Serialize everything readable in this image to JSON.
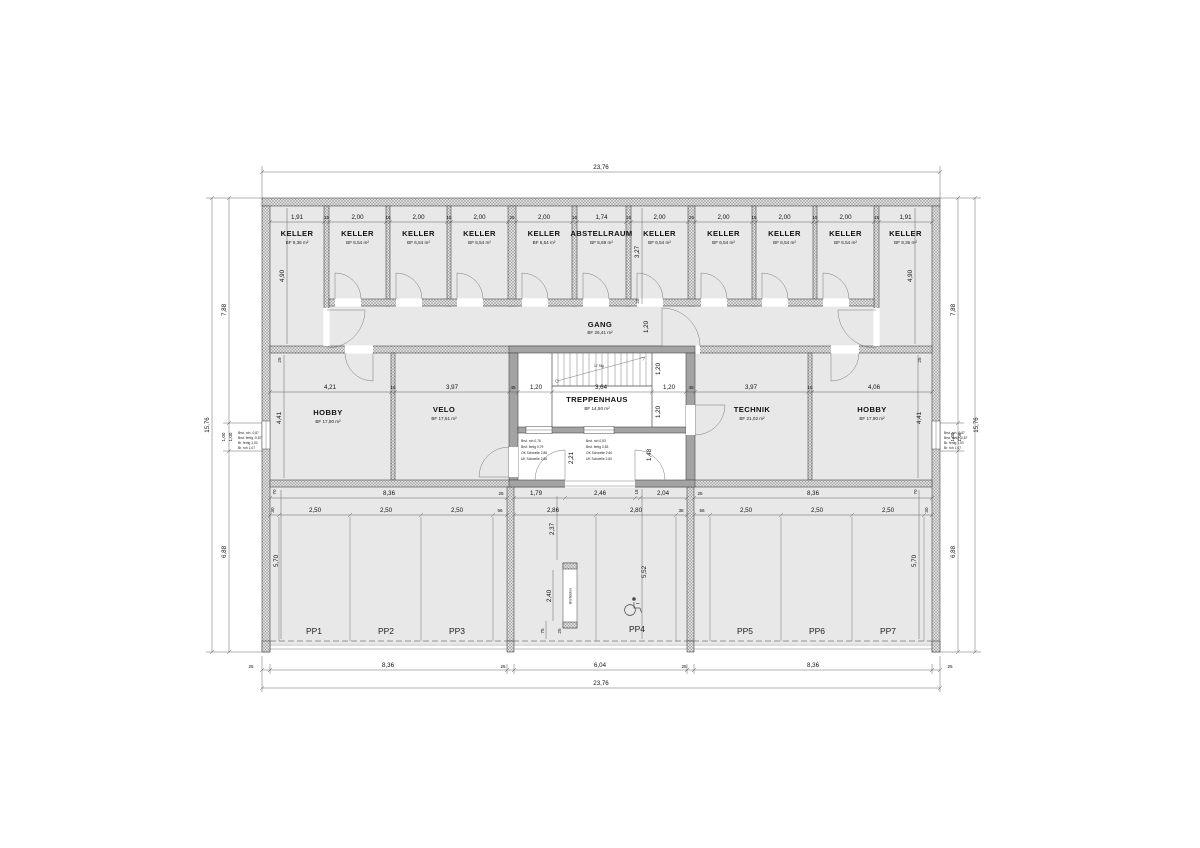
{
  "plan": {
    "top_rooms": [
      {
        "name": "KELLER",
        "area": "BF 9,36 m²"
      },
      {
        "name": "KELLER",
        "area": "BF 6,54 m²"
      },
      {
        "name": "KELLER",
        "area": "BF 6,54 m²"
      },
      {
        "name": "KELLER",
        "area": "BF 6,54 m²"
      },
      {
        "name": "KELLER",
        "area": "BF 6,54 m²"
      },
      {
        "name": "ABSTELLRAUM",
        "area": "BF 5,69 m²"
      },
      {
        "name": "KELLER",
        "area": "BF 6,54 m²"
      },
      {
        "name": "KELLER",
        "area": "BF 6,54 m²"
      },
      {
        "name": "KELLER",
        "area": "BF 6,54 m²"
      },
      {
        "name": "KELLER",
        "area": "BF 6,54 m²"
      },
      {
        "name": "KELLER",
        "area": "BF 9,36 m²"
      }
    ],
    "gang": {
      "name": "GANG",
      "area": "BF 26,41 m²"
    },
    "treppenhaus": {
      "name": "TREPPENHAUS",
      "area": "BF 14,50 m²"
    },
    "stair_note": "17 Stg.",
    "middle_rooms": [
      {
        "name": "HOBBY",
        "area": "BF 17,90 m²"
      },
      {
        "name": "VELO",
        "area": "BF 17,51 m²"
      },
      {
        "name": "TECHNIK",
        "area": "BF 21,02 m²"
      },
      {
        "name": "HOBBY",
        "area": "BF 17,90 m²"
      }
    ],
    "parking": [
      "PP1",
      "PP2",
      "PP3",
      "PP4",
      "PP5",
      "PP6",
      "PP7"
    ],
    "mailbox_label": "Briefkästen",
    "dims": {
      "top_total": "23,76",
      "bottom_total": "23,76",
      "side_total_left": "15,76",
      "side_total_right": "15,76",
      "top_chain": [
        "1,91",
        "15",
        "2,00",
        "15",
        "2,00",
        "15",
        "2,00",
        "25",
        "2,00",
        "15",
        "1,74",
        "15",
        "2,00",
        "25",
        "2,00",
        "15",
        "2,00",
        "15",
        "2,00",
        "15",
        "1,91"
      ],
      "mid_chain": [
        "4,21",
        "15",
        "3,97",
        "45",
        "1,20",
        "3,64",
        "1,20",
        "45",
        "3,97",
        "15",
        "4,06"
      ],
      "left_chain": [
        "7,88",
        "1,00",
        "1,00",
        "6,88"
      ],
      "right_chain": [
        "7,88",
        "1,00",
        "1,00",
        "6,88"
      ],
      "bottom_chain": [
        "25",
        "8,36",
        "25",
        "6,04",
        "25",
        "8,36",
        "25"
      ],
      "gl_r1": [
        "70",
        "8,36",
        "25"
      ],
      "gl_r2": [
        "30",
        "2,50",
        "2,50",
        "2,50",
        "56"
      ],
      "gc_r1": [
        "1,79",
        "2,46",
        "18",
        "2,04"
      ],
      "gc_r2": [
        "2,86",
        "2,80",
        "38"
      ],
      "gr_r1": [
        "25",
        "8,36",
        "70"
      ],
      "gr_r2": [
        "56",
        "2,50",
        "2,50",
        "2,50",
        "30"
      ],
      "v": {
        "keller_l": "4,90",
        "keller_r": "4,90",
        "abst": "3,27",
        "w25a": "25",
        "gang": "1,20",
        "stair1": "1,20",
        "stair2": "1,20",
        "mid25l": "25",
        "mid_l": "4,41",
        "mid25r": "25",
        "mid_r": "4,41",
        "vest_l": "2,21",
        "vest_r": "1,48",
        "court": "2,37",
        "gar_l": "5,70",
        "gar_r": "5,70",
        "mailbox": "2,40",
        "pp4": "5,52",
        "p75": "75",
        "p25": "25"
      }
    },
    "notes": {
      "wall_left": [
        "Brst. roh  -0,87",
        "Brst. fertig  -0,87",
        "Br. fertig  1,00",
        "Br. roh  1,07"
      ],
      "wall_right": [
        "Brst. roh  -0,87",
        "Brst. fertig  -0,87",
        "Br. fertig  1,00",
        "Br. roh  1,07"
      ],
      "vest_left": [
        "Brst. roh  0,76",
        "Brst. fertig  0,79",
        "OK Schwelle  2,86",
        "UK Schwelle  2,86"
      ],
      "vest_right": [
        "Brst. roh  0,83",
        "Brst. fertig  0,83",
        "OK Schwelle  2,60",
        "UK Schwelle  2,60"
      ]
    }
  }
}
